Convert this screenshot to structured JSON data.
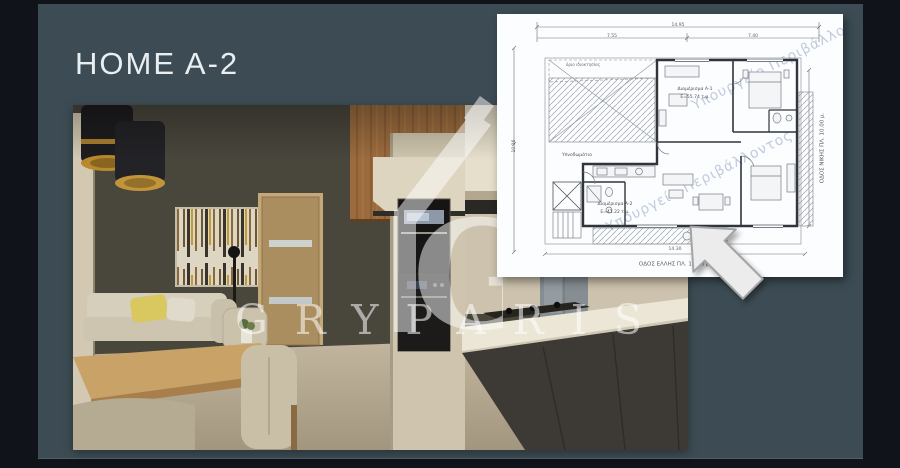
{
  "slide": {
    "title": "HOME A-2"
  },
  "brand": {
    "name": "GRYPARIS",
    "logo": "house-g-monogram",
    "monogram_letter": "G"
  },
  "colors": {
    "slide_background": "#3d4c54",
    "frame": "#10141a",
    "watermark": "rgba(255,255,255,0.55)",
    "plan_stamp": "#b6c2d8"
  },
  "floor_plan": {
    "stamp_text": "Υπουργείο Περιβάλλοντος",
    "street_label_bottom": "ΟΔΟΣ ΕΛΛΗΣ ΠΛ. 10.00 μ.",
    "street_label_right": "ΟΔΟΣ ΝΙΚΗΣ ΠΛ. 10.00 μ.",
    "boundary_label": "όριο ιδιοκτησίας",
    "dimensions": {
      "top_total": "14.95",
      "top_left": "7.55",
      "top_right": "7.40",
      "left_height": "10.16",
      "bottom_total": "14.30"
    },
    "rooms": [
      {
        "label": "Διαμέρισμα Α-1",
        "area": "Ε=55.74 τ.μ."
      },
      {
        "label": "Διαμέρισμα Α-2",
        "area": "Ε=41.22 τ.μ."
      },
      {
        "label": "Υπνοδωμάτιο",
        "area": ""
      }
    ]
  }
}
